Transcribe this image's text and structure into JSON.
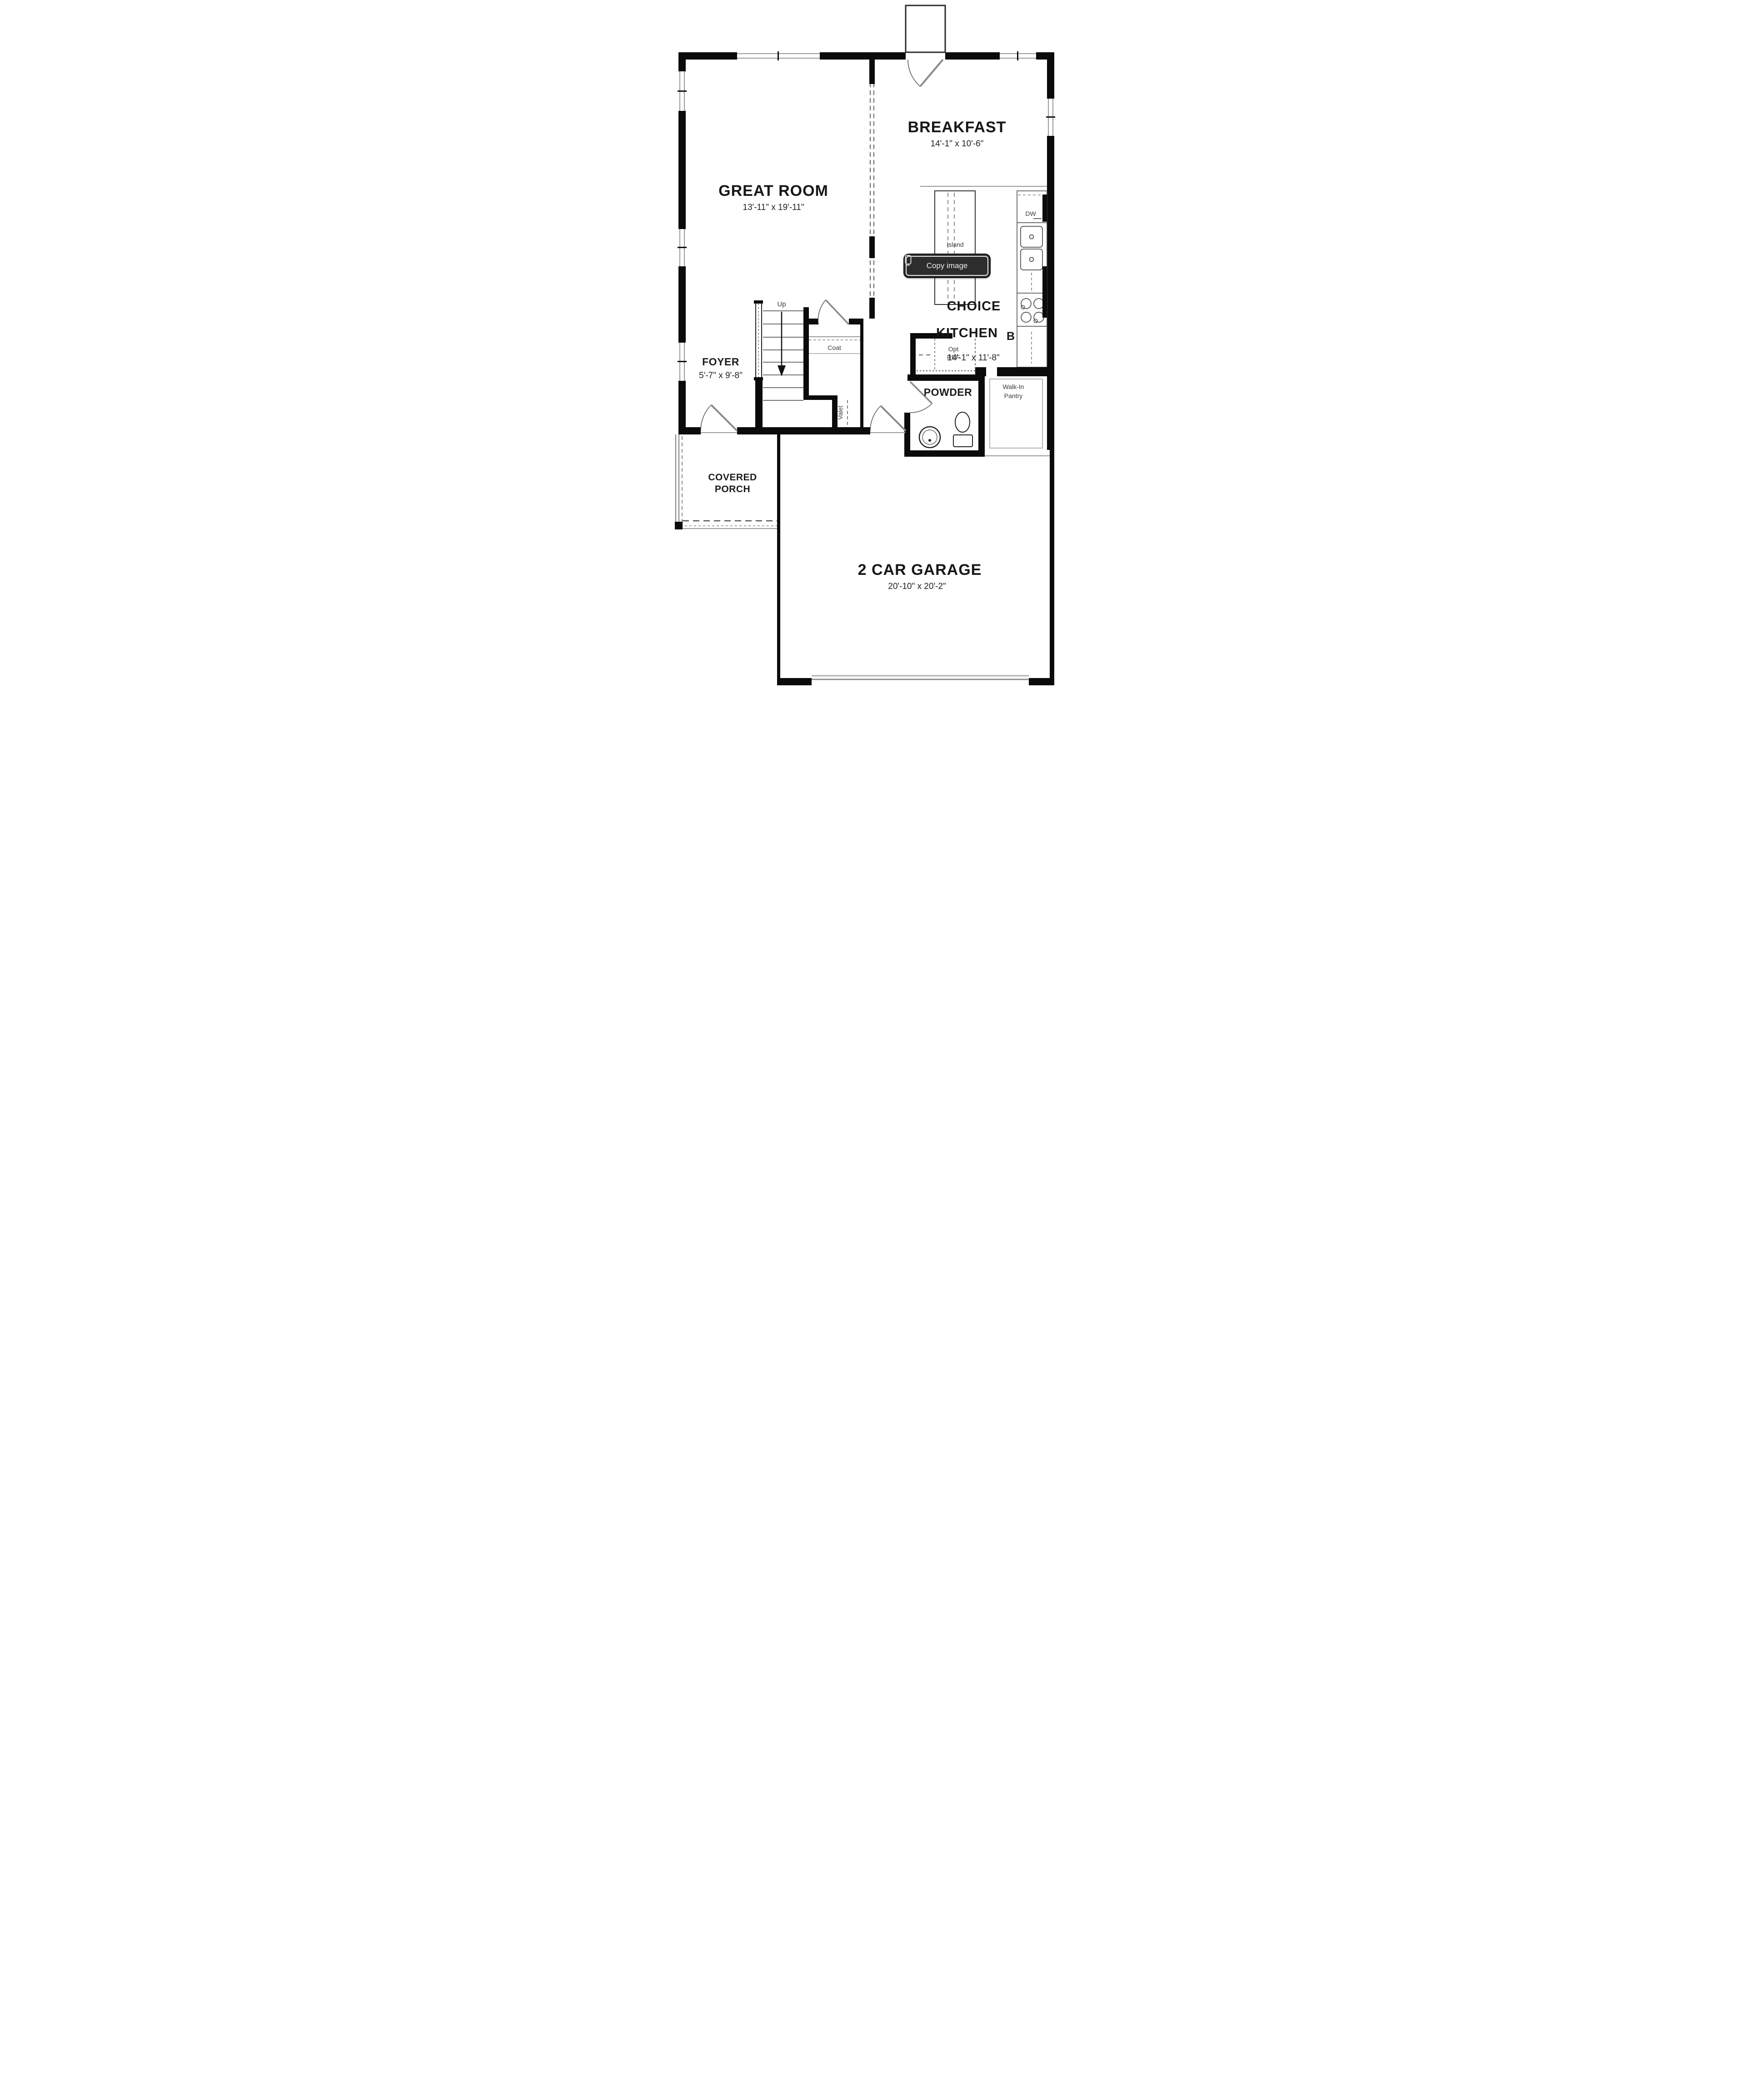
{
  "overlay": {
    "copy_button": {
      "label": "Copy image",
      "icon": "copy-image-icon"
    }
  },
  "floor_plan": {
    "rooms": {
      "great_room": {
        "name": "GREAT ROOM",
        "dims": "13'-11\" x 19'-11\""
      },
      "breakfast": {
        "name": "BREAKFAST",
        "dims": "14'-1\" x 10'-6\""
      },
      "kitchen": {
        "name_line1": "CHOICE",
        "name_line2": "KITCHEN",
        "variant": "B",
        "dims": "14'-1\" x 11'-8\""
      },
      "foyer": {
        "name": "FOYER",
        "dims": "5'-7\" x 9'-8\""
      },
      "powder": {
        "name": "POWDER"
      },
      "garage": {
        "name": "2 CAR GARAGE",
        "dims": "20'-10\" x 20'-2\""
      },
      "covered_porch": {
        "line1": "COVERED",
        "line2": "PORCH"
      },
      "walk_in_pantry": {
        "line1": "Walk-In",
        "line2": "Pantry"
      }
    },
    "features": {
      "island": "Island",
      "coat": "Coat",
      "valet": "Valet",
      "stairs_up": "Up",
      "dishwasher": "DW",
      "opt_ref_line1": "Opt",
      "opt_ref_line2": "REF"
    },
    "colors": {
      "wall": "#0b0b0b",
      "line_gray": "#999999",
      "button_bg": "#2d2d2d",
      "button_text": "#ececec"
    }
  }
}
